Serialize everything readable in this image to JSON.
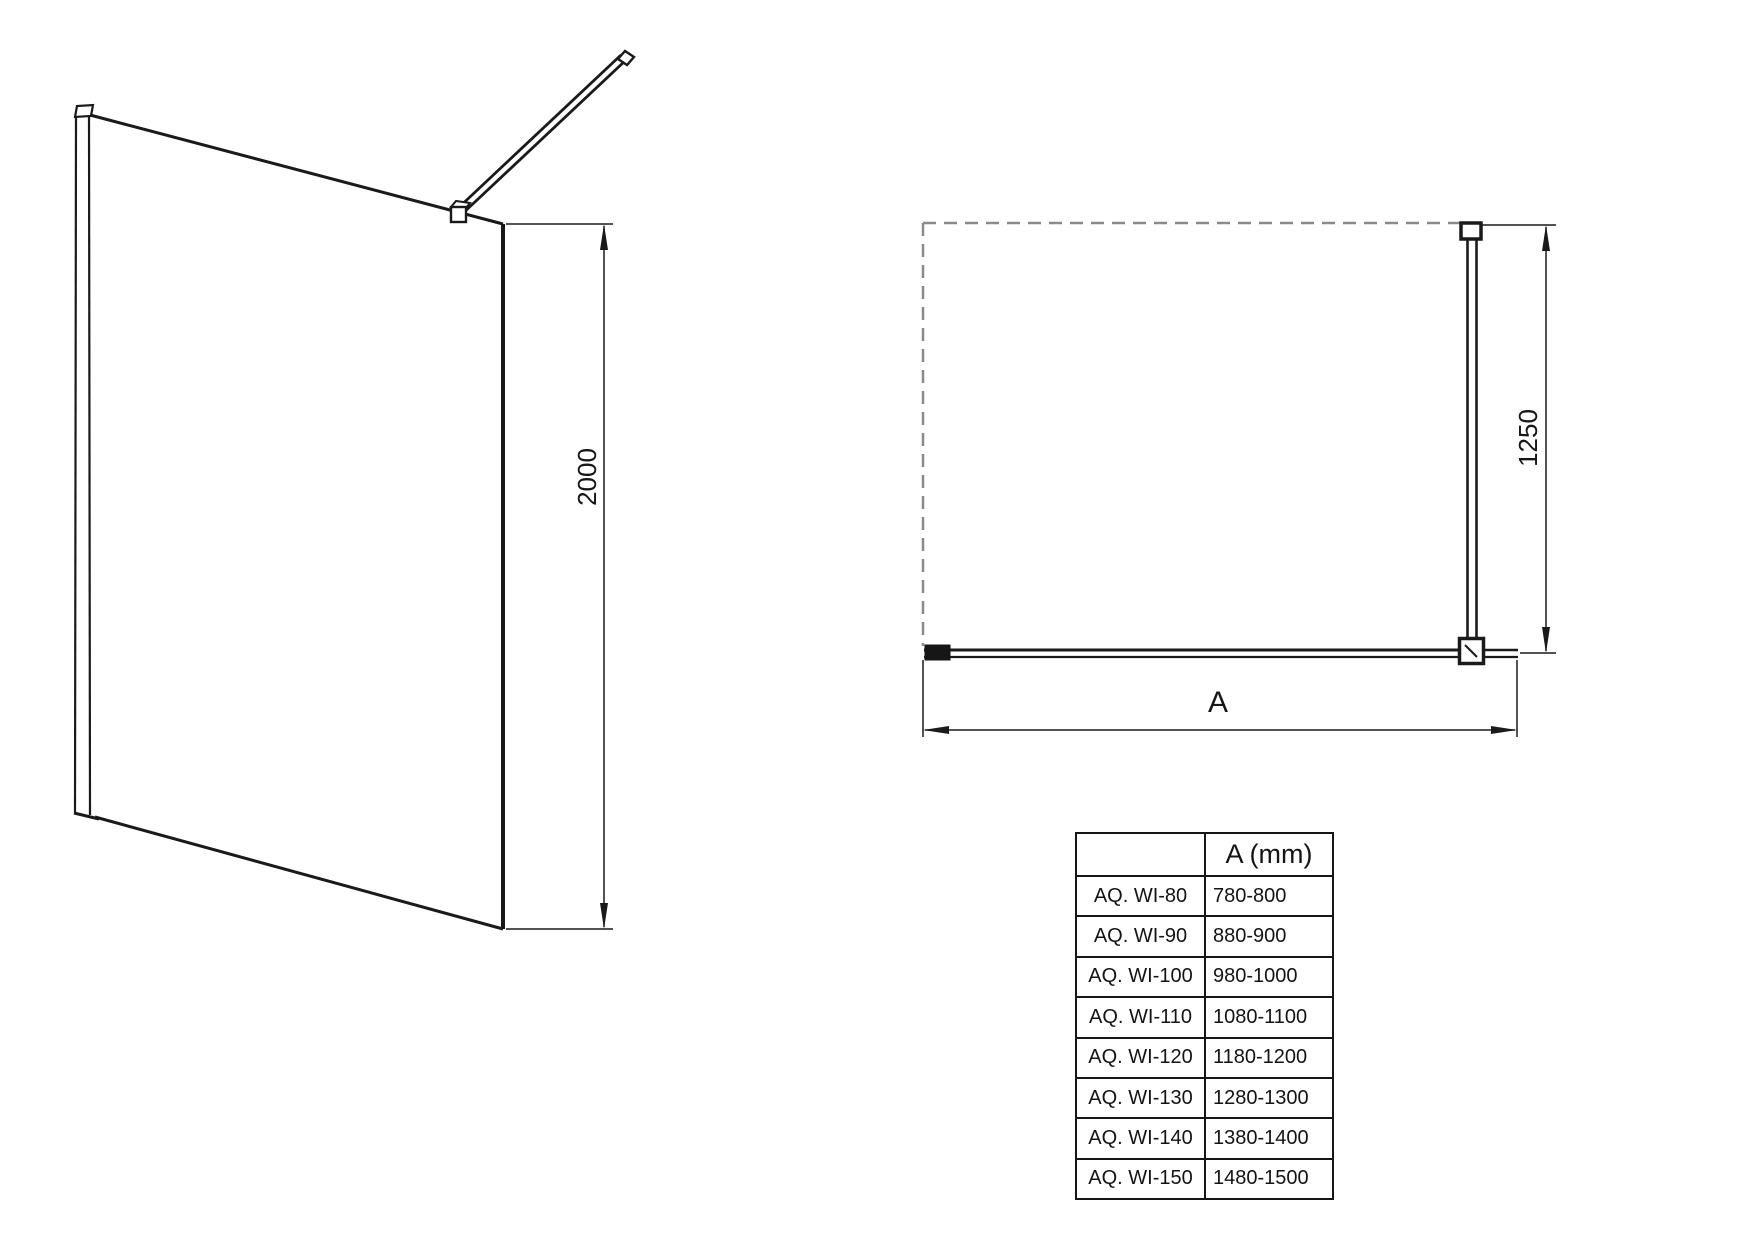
{
  "drawing": {
    "side_view": {
      "height_dimension": "2000"
    },
    "plan_view": {
      "depth_dimension": "1250",
      "width_dimension": "A"
    }
  },
  "size_table": {
    "headers": {
      "model": "",
      "width": "A (mm)"
    },
    "rows": [
      {
        "model": "AQ. WI-80",
        "width_range": "780-800"
      },
      {
        "model": "AQ. WI-90",
        "width_range": "880-900"
      },
      {
        "model": "AQ. WI-100",
        "width_range": "980-1000"
      },
      {
        "model": "AQ. WI-110",
        "width_range": "1080-1100"
      },
      {
        "model": "AQ. WI-120",
        "width_range": "1180-1200"
      },
      {
        "model": "AQ. WI-130",
        "width_range": "1280-1300"
      },
      {
        "model": "AQ. WI-140",
        "width_range": "1380-1400"
      },
      {
        "model": "AQ. WI-150",
        "width_range": "1480-1500"
      }
    ]
  }
}
